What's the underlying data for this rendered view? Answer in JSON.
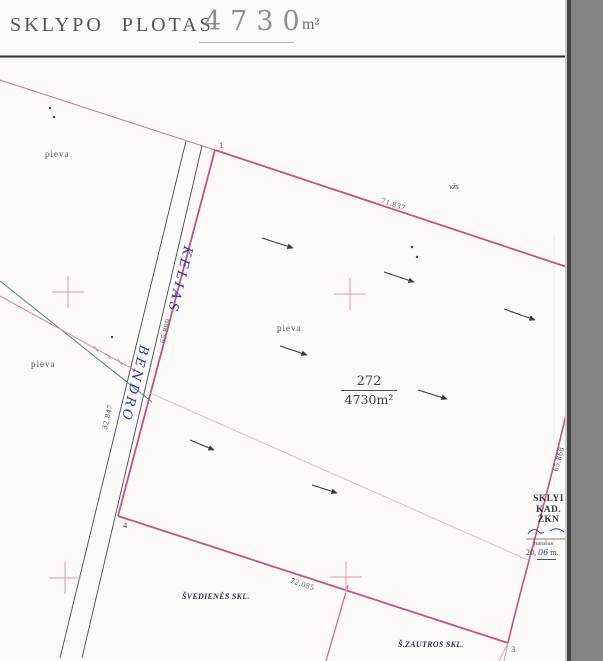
{
  "header": {
    "title": "SKLYPO PLOTAS",
    "value": "4730",
    "unit": "m²"
  },
  "parcel": {
    "number": "272",
    "area": "4730m²"
  },
  "land_use": {
    "pieva": "pieva",
    "vzs": "vžs"
  },
  "road": {
    "name_top": "KELIAS",
    "name_bottom": "BENDRO"
  },
  "measurements": {
    "north": "71.837",
    "south": "72.085",
    "west": "65.889",
    "east": "65.868",
    "road_edge": "32.847"
  },
  "vertices": {
    "v1": "1",
    "v3": "3",
    "v4": "4"
  },
  "neighbors": {
    "southwest": "ŠVEDIENĖS SKL.",
    "southeast": "Š.ZAUTROS SKL."
  },
  "stamp": {
    "line1": "SKLYI",
    "line2": "KAD.",
    "line3": "ŽKN",
    "signature_label": "parašas",
    "date_prefix": "20,",
    "date_hand": "06",
    "date_suffix": "m."
  },
  "colors": {
    "boundary_pink": "#c94f82",
    "survey_cross_pink": "#e8a6bd",
    "handwriting_blue": "#2a3a9e",
    "teal_line": "#4e8a7c",
    "scanner_grey": "#828282"
  }
}
